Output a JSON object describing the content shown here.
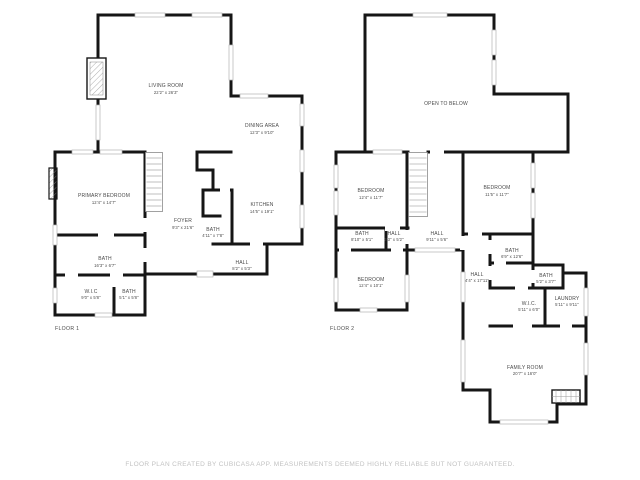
{
  "colors": {
    "background": "#ffffff",
    "walls": "#161616",
    "room_text": "#4a4a4a",
    "window": "#b4b4b4",
    "footer_text": "#c2c2c2"
  },
  "floors": [
    {
      "label": "FLOOR 1",
      "rooms": [
        {
          "name": "LIVING ROOM",
          "dims": "22'2\" x 26'3\""
        },
        {
          "name": "DINING AREA",
          "dims": "12'3\" x 9'10\""
        },
        {
          "name": "PRIMARY BEDROOM",
          "dims": "12'4\" x 14'7\""
        },
        {
          "name": "FOYER",
          "dims": "9'3\" x 21'6\""
        },
        {
          "name": "BATH",
          "dims": "4'11\" x 7'8\""
        },
        {
          "name": "KITCHEN",
          "dims": "14'5\" x 19'1\""
        },
        {
          "name": "BATH",
          "dims": "16'3\" x 6'7\""
        },
        {
          "name": "HALL",
          "dims": "8'2\" x 5'3\""
        },
        {
          "name": "W.I.C",
          "dims": "9'0\" x 5'8\""
        },
        {
          "name": "BATH",
          "dims": "5'1\" x 5'8\""
        }
      ]
    },
    {
      "label": "FLOOR 2",
      "rooms": [
        {
          "name": "OPEN TO BELOW",
          "dims": ""
        },
        {
          "name": "BEDROOM",
          "dims": "12'4\" x 11'7\""
        },
        {
          "name": "BEDROOM",
          "dims": "11'5\" x 11'7\""
        },
        {
          "name": "BATH",
          "dims": "8'10\" x 5'1\""
        },
        {
          "name": "HALL",
          "dims": "3'3\" x 5'2\""
        },
        {
          "name": "HALL",
          "dims": "9'11\" x 5'6\""
        },
        {
          "name": "BEDROOM",
          "dims": "12'4\" x 10'1\""
        },
        {
          "name": "HALL",
          "dims": "4'4\" x 17'11\""
        },
        {
          "name": "BATH",
          "dims": "6'9\" x 12'6\""
        },
        {
          "name": "BATH",
          "dims": "5'2\" x 3'7\""
        },
        {
          "name": "W.I.C.",
          "dims": "5'11\" x 6'0\""
        },
        {
          "name": "LAUNDRY",
          "dims": "5'11\" x 9'11\""
        },
        {
          "name": "FAMILY ROOM",
          "dims": "20'7\" x 16'0\""
        }
      ]
    }
  ],
  "footer": {
    "text": "FLOOR PLAN CREATED BY CUBICASA APP. MEASUREMENTS DEEMED HIGHLY RELIABLE BUT NOT GUARANTEED."
  }
}
